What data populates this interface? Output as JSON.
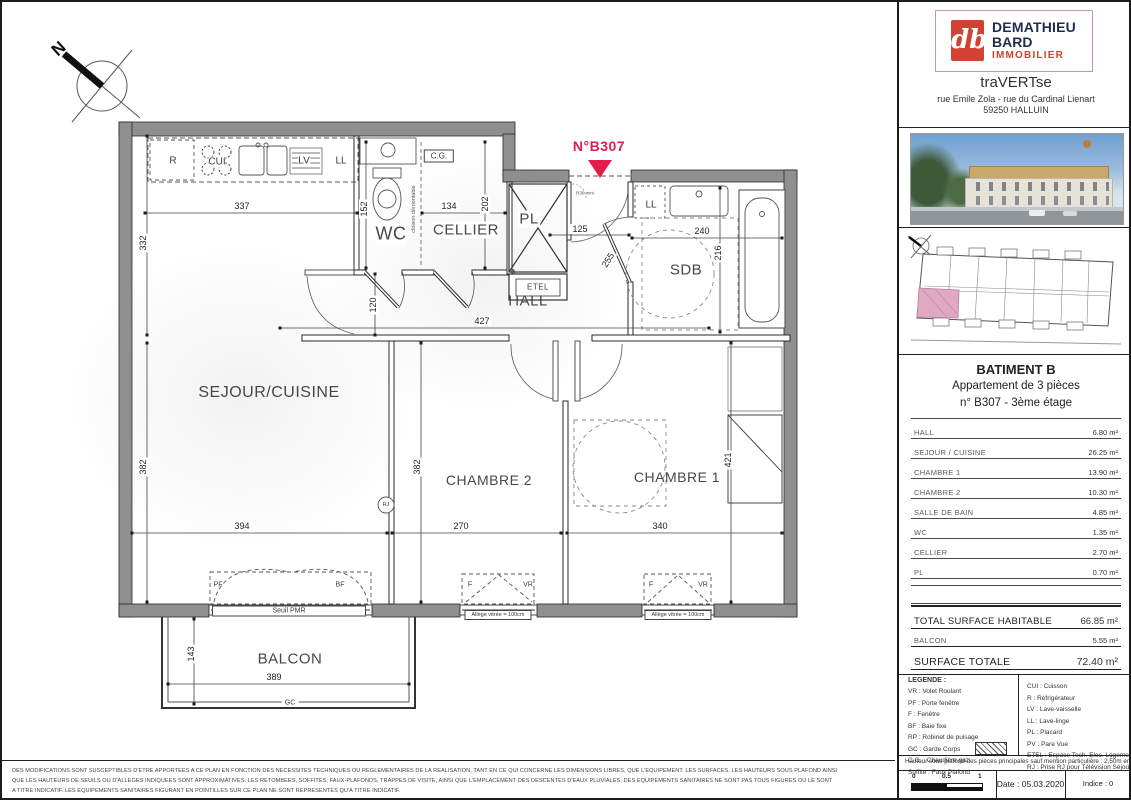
{
  "colors": {
    "accent_pink": "#e31c4e",
    "wall_gray": "#8f8f8f",
    "keyplan_highlight": "#dfa9c2",
    "brand_red": "#d14233",
    "brand_navy": "#1e2c4f"
  },
  "plan": {
    "north": "N",
    "unit_number": "N°B307",
    "rooms": {
      "sejour": "SEJOUR/CUISINE",
      "chambre2": "CHAMBRE 2",
      "chambre1": "CHAMBRE 1",
      "hall": "HALL",
      "wc": "WC",
      "cellier": "CELLIER",
      "pl": "PL",
      "sdb": "SDB",
      "balcon": "BALCON"
    },
    "fixtures": {
      "fridge": "R",
      "cooktop": "CUI",
      "dishwasher": "LV",
      "washer": "LL",
      "boiler": "C.G.",
      "etel": "ETEL",
      "rj": "RJ"
    },
    "dims": {
      "d337": "337",
      "d134": "134",
      "d202": "202",
      "d332": "332",
      "d152": "152",
      "d120": "120",
      "d125": "125",
      "d255": "255",
      "d240": "240",
      "d216": "216",
      "d427": "427",
      "d382a": "382",
      "d382b": "382",
      "d394": "394",
      "d270": "270",
      "d340": "340",
      "d421": "421",
      "d143": "143",
      "d389": "389"
    },
    "notes": {
      "seuil": "Seuil PMR",
      "allege": "Allège vitrée = 100cm",
      "cloison": "cloison démontable",
      "r30": "R30 mini",
      "gc": "GC",
      "pf": "PF",
      "bf": "BF",
      "f": "F",
      "vr": "VR"
    }
  },
  "sidebar": {
    "logo": {
      "monogram": "db",
      "name1": "DEMATHIEU",
      "name2": "BARD",
      "name3": "IMMOBILIER"
    },
    "project": {
      "name": "traVERTse",
      "address1": "rue Emile Zola - rue du Cardinal Lienart",
      "address2": "59250 HALLUIN"
    },
    "apartment": {
      "building": "BATIMENT B",
      "type": "Appartement de 3 pièces",
      "unit": "n° B307 - 3ème étage"
    },
    "rooms": [
      {
        "label": "HALL",
        "area": "6.80 m²"
      },
      {
        "label": "SEJOUR / CUISINE",
        "area": "26.25 m²"
      },
      {
        "label": "CHAMBRE 1",
        "area": "13.90 m²"
      },
      {
        "label": "CHAMBRE 2",
        "area": "10.30 m²"
      },
      {
        "label": "SALLE DE BAIN",
        "area": "4.85 m²"
      },
      {
        "label": "WC",
        "area": "1.35 m²"
      },
      {
        "label": "CELLIER",
        "area": "2.70 m²"
      },
      {
        "label": "PL",
        "area": "0.70 m²"
      }
    ],
    "totals": {
      "habitable": {
        "label": "TOTAL SURFACE HABITABLE",
        "area": "66.85 m²"
      },
      "balcon": {
        "label": "BALCON",
        "area": "5.55 m²"
      },
      "totale": {
        "label": "SURFACE TOTALE",
        "area": "72.40 m²"
      }
    },
    "legend": {
      "title": "LEGENDE :",
      "left": [
        "VR : Volet Roulant",
        "PF : Porte fenêtre",
        "F : Fenêtre",
        "BF : Baie fixe",
        "RP : Robinet de puisage",
        "GC : Garde Corps",
        "C.G. : Chaudière gaz",
        "Soffite : Faux Plafond"
      ],
      "right": [
        "CUI : Cuisson",
        "R : Réfrigérateur",
        "LV : Lave-vaisselle",
        "LL : Lave-linge",
        "PL : Placard",
        "PV : Pare Vue",
        "ETEL : Espace Tech. Elec. Logement",
        "RJ : Prise RJ pour Télévision Séjour"
      ]
    },
    "ceiling_note": "Hauteur sous plafond des pièces principales sauf mention particulière : 2,50m env.",
    "scalebar": {
      "t0": "0",
      "t05": "0.5",
      "t1": "1"
    },
    "date": "Date : 05.03.2020",
    "indice": "Indice : 0"
  },
  "footer": {
    "line1": "DES MODIFICATIONS SONT SUSCEPTIBLES D'ETRE APPORTEES A CE PLAN EN FONCTION DES NECESSITES TECHNIQUES OU REGLEMENTAIRES DE LA REALISATION, TANT EN CE QUI CONCERNE LES DIMENSIONS LIBRES, QUE L'EQUIPEMENT. LES SURFACES, LES HAUTEURS SOUS PLAFOND AINSI",
    "line2": "QUE LES HAUTEURS DE SEUILS OU D'ALLEGES INDIQUEES SONT APPROXIMATIVES. LES RETOMBEES, SOFFITES, FAUX-PLAFONDS, TRAPPES DE VISITE, AINSI QUE L'EMPLACEMENT DES DESCENTES D'EAUX PLUVIALES, DES EQUIPEMENTS SANITAIRES NE SONT PAS TOUS FIGURES OU LE SONT",
    "line3": "A TITRE INDICATIF. LES EQUIPEMENTS SANITAIRES FIGURANT EN POINTILLES SUR CE PLAN NE SONT REPRESENTES QU'A TITRE INDICATIF."
  }
}
